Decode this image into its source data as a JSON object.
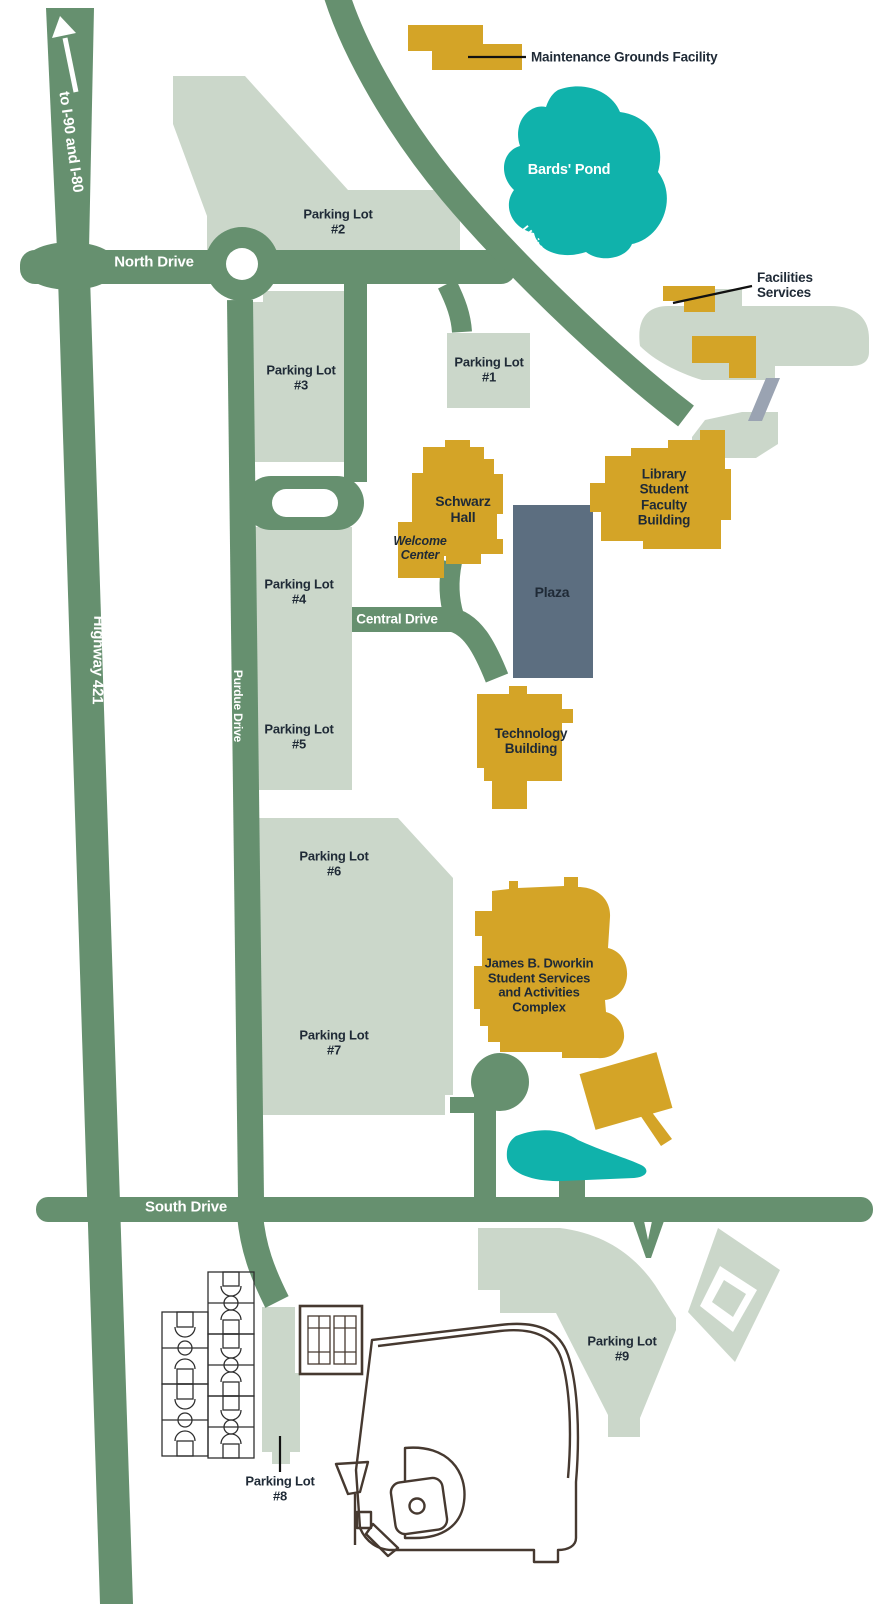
{
  "map": {
    "roads": {
      "ramp": "to I-90 and I-80",
      "highway": "Highway 421",
      "north": "North Drive",
      "university": "University Drive",
      "purdue": "Purdue Drive",
      "central": "Central Drive",
      "south": "South Drive"
    },
    "lots": {
      "lot1": [
        "Parking Lot",
        "#1"
      ],
      "lot2": [
        "Parking Lot",
        "#2"
      ],
      "lot3": [
        "Parking Lot",
        "#3"
      ],
      "lot4": [
        "Parking Lot",
        "#4"
      ],
      "lot5": [
        "Parking Lot",
        "#5"
      ],
      "lot6": [
        "Parking Lot",
        "#6"
      ],
      "lot7": [
        "Parking Lot",
        "#7"
      ],
      "lot8": [
        "Parking Lot",
        "#8"
      ],
      "lot9": [
        "Parking Lot",
        "#9"
      ]
    },
    "buildings": {
      "maintenance": "Maintenance Grounds Facility",
      "facilities": [
        "Facilities",
        "Services"
      ],
      "schwarz": [
        "Schwarz",
        "Hall"
      ],
      "welcome": [
        "Welcome",
        "Center"
      ],
      "library": [
        "Library",
        "Student",
        "Faculty",
        "Building"
      ],
      "plaza": "Plaza",
      "technology": [
        "Technology",
        "Building"
      ],
      "dworkin": [
        "James B. Dworkin",
        "Student Services",
        "and Activities",
        "Complex"
      ]
    },
    "water": {
      "bards_pond": "Bards' Pond"
    },
    "colors": {
      "road": "#66906f",
      "lot": "#cbd7ca",
      "gold": "#d4a427",
      "teal": "#10b2ab",
      "plaza": "#5c6e80",
      "gray": "#9aa3b2",
      "label": "#1f2a36",
      "court": "#2f2f2f",
      "field": "#463930"
    }
  }
}
